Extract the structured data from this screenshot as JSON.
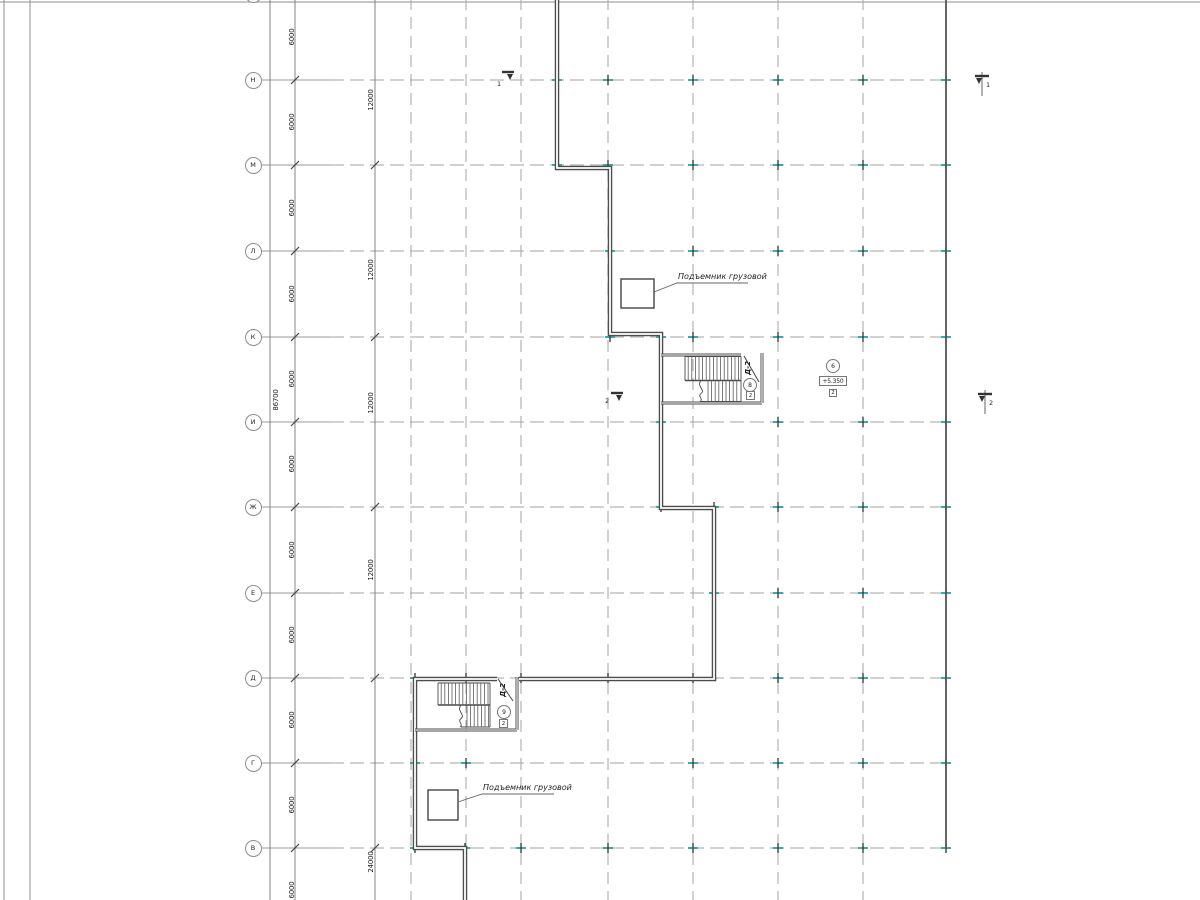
{
  "grid": {
    "row_labels": [
      "",
      "Н",
      "М",
      "Л",
      "К",
      "И",
      "Ж",
      "Е",
      "Д",
      "Г",
      "В"
    ]
  },
  "dimensions": {
    "bays": [
      "6000",
      "6000",
      "6000",
      "6000",
      "6000",
      "6000",
      "6000",
      "6000",
      "6000",
      "6000",
      "6000"
    ],
    "chain2": [
      "12000",
      "12000",
      "12000",
      "12000",
      "24000"
    ],
    "total": "86700"
  },
  "annotations": {
    "lift_top": "Подъемник грузовой",
    "lift_bottom": "Подъемник грузовой"
  },
  "stairs": {
    "top": {
      "name": "Д-2",
      "circle": "8",
      "box": "2"
    },
    "bottom": {
      "name": "Д-2",
      "circle": "9",
      "box": "2"
    }
  },
  "level_mark": {
    "circle": "6",
    "elevation": "+5.350",
    "box": "2"
  },
  "section_marks": [
    {
      "label": "1"
    },
    {
      "label": "1"
    },
    {
      "label": "2"
    },
    {
      "label": "2"
    }
  ],
  "colors": {
    "teal": "#3fa8a8",
    "wall": "#4d4d4d",
    "grid_line": "#a3a3a3",
    "text": "#222222"
  }
}
